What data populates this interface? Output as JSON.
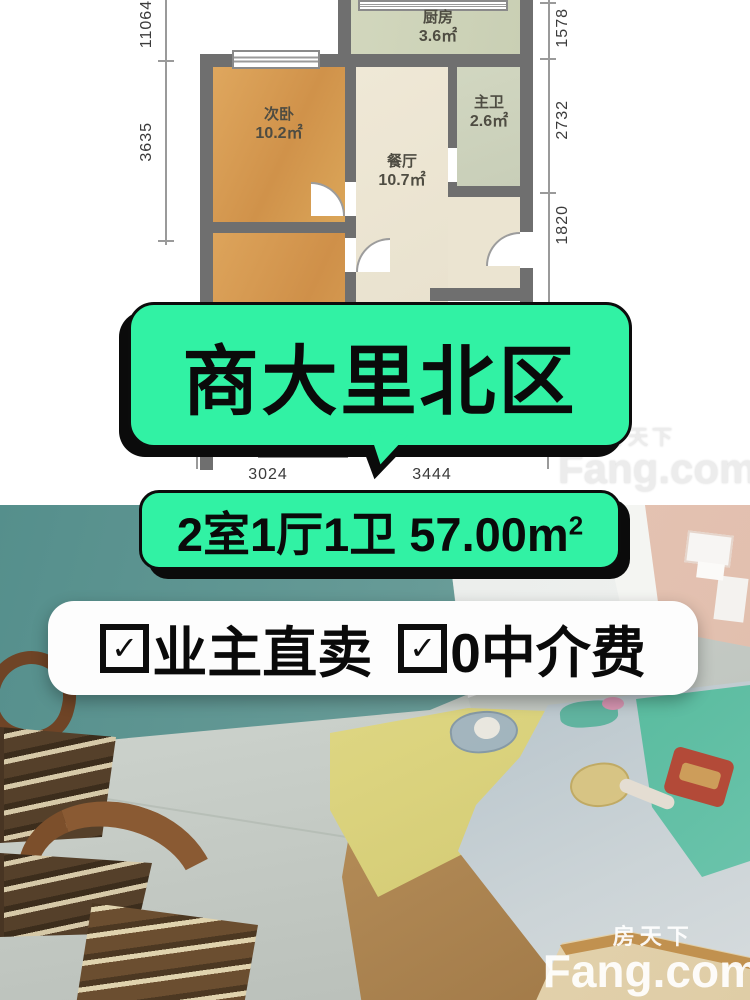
{
  "colors": {
    "accent_green": "#31f2a4",
    "wall_teal": "#679b97",
    "text_black": "#0a0a0a"
  },
  "floor_plan": {
    "rooms": [
      {
        "id": "kitchen",
        "name": "厨房",
        "area": "3.6㎡"
      },
      {
        "id": "second-bedroom",
        "name": "次卧",
        "area": "10.2㎡"
      },
      {
        "id": "dining",
        "name": "餐厅",
        "area": "10.7㎡"
      },
      {
        "id": "master-bath",
        "name": "主卫",
        "area": "2.6㎡"
      }
    ],
    "dimensions": {
      "left_top": "110647",
      "left_mid": "3635",
      "right_top": "1578",
      "right_mid": "2732",
      "right_bottom": "1820",
      "bottom_left": "3024",
      "bottom_right": "3444"
    }
  },
  "overlays": {
    "title": "商大里北区",
    "spec": "2室1厅1卫 57.00m",
    "spec_sup": "2",
    "features": [
      {
        "check": "✓",
        "label": "业主直卖"
      },
      {
        "check": "✓",
        "label": "0中介费"
      }
    ]
  },
  "watermark": {
    "brand_cn": "房天下",
    "brand_en": "Fang.com"
  }
}
